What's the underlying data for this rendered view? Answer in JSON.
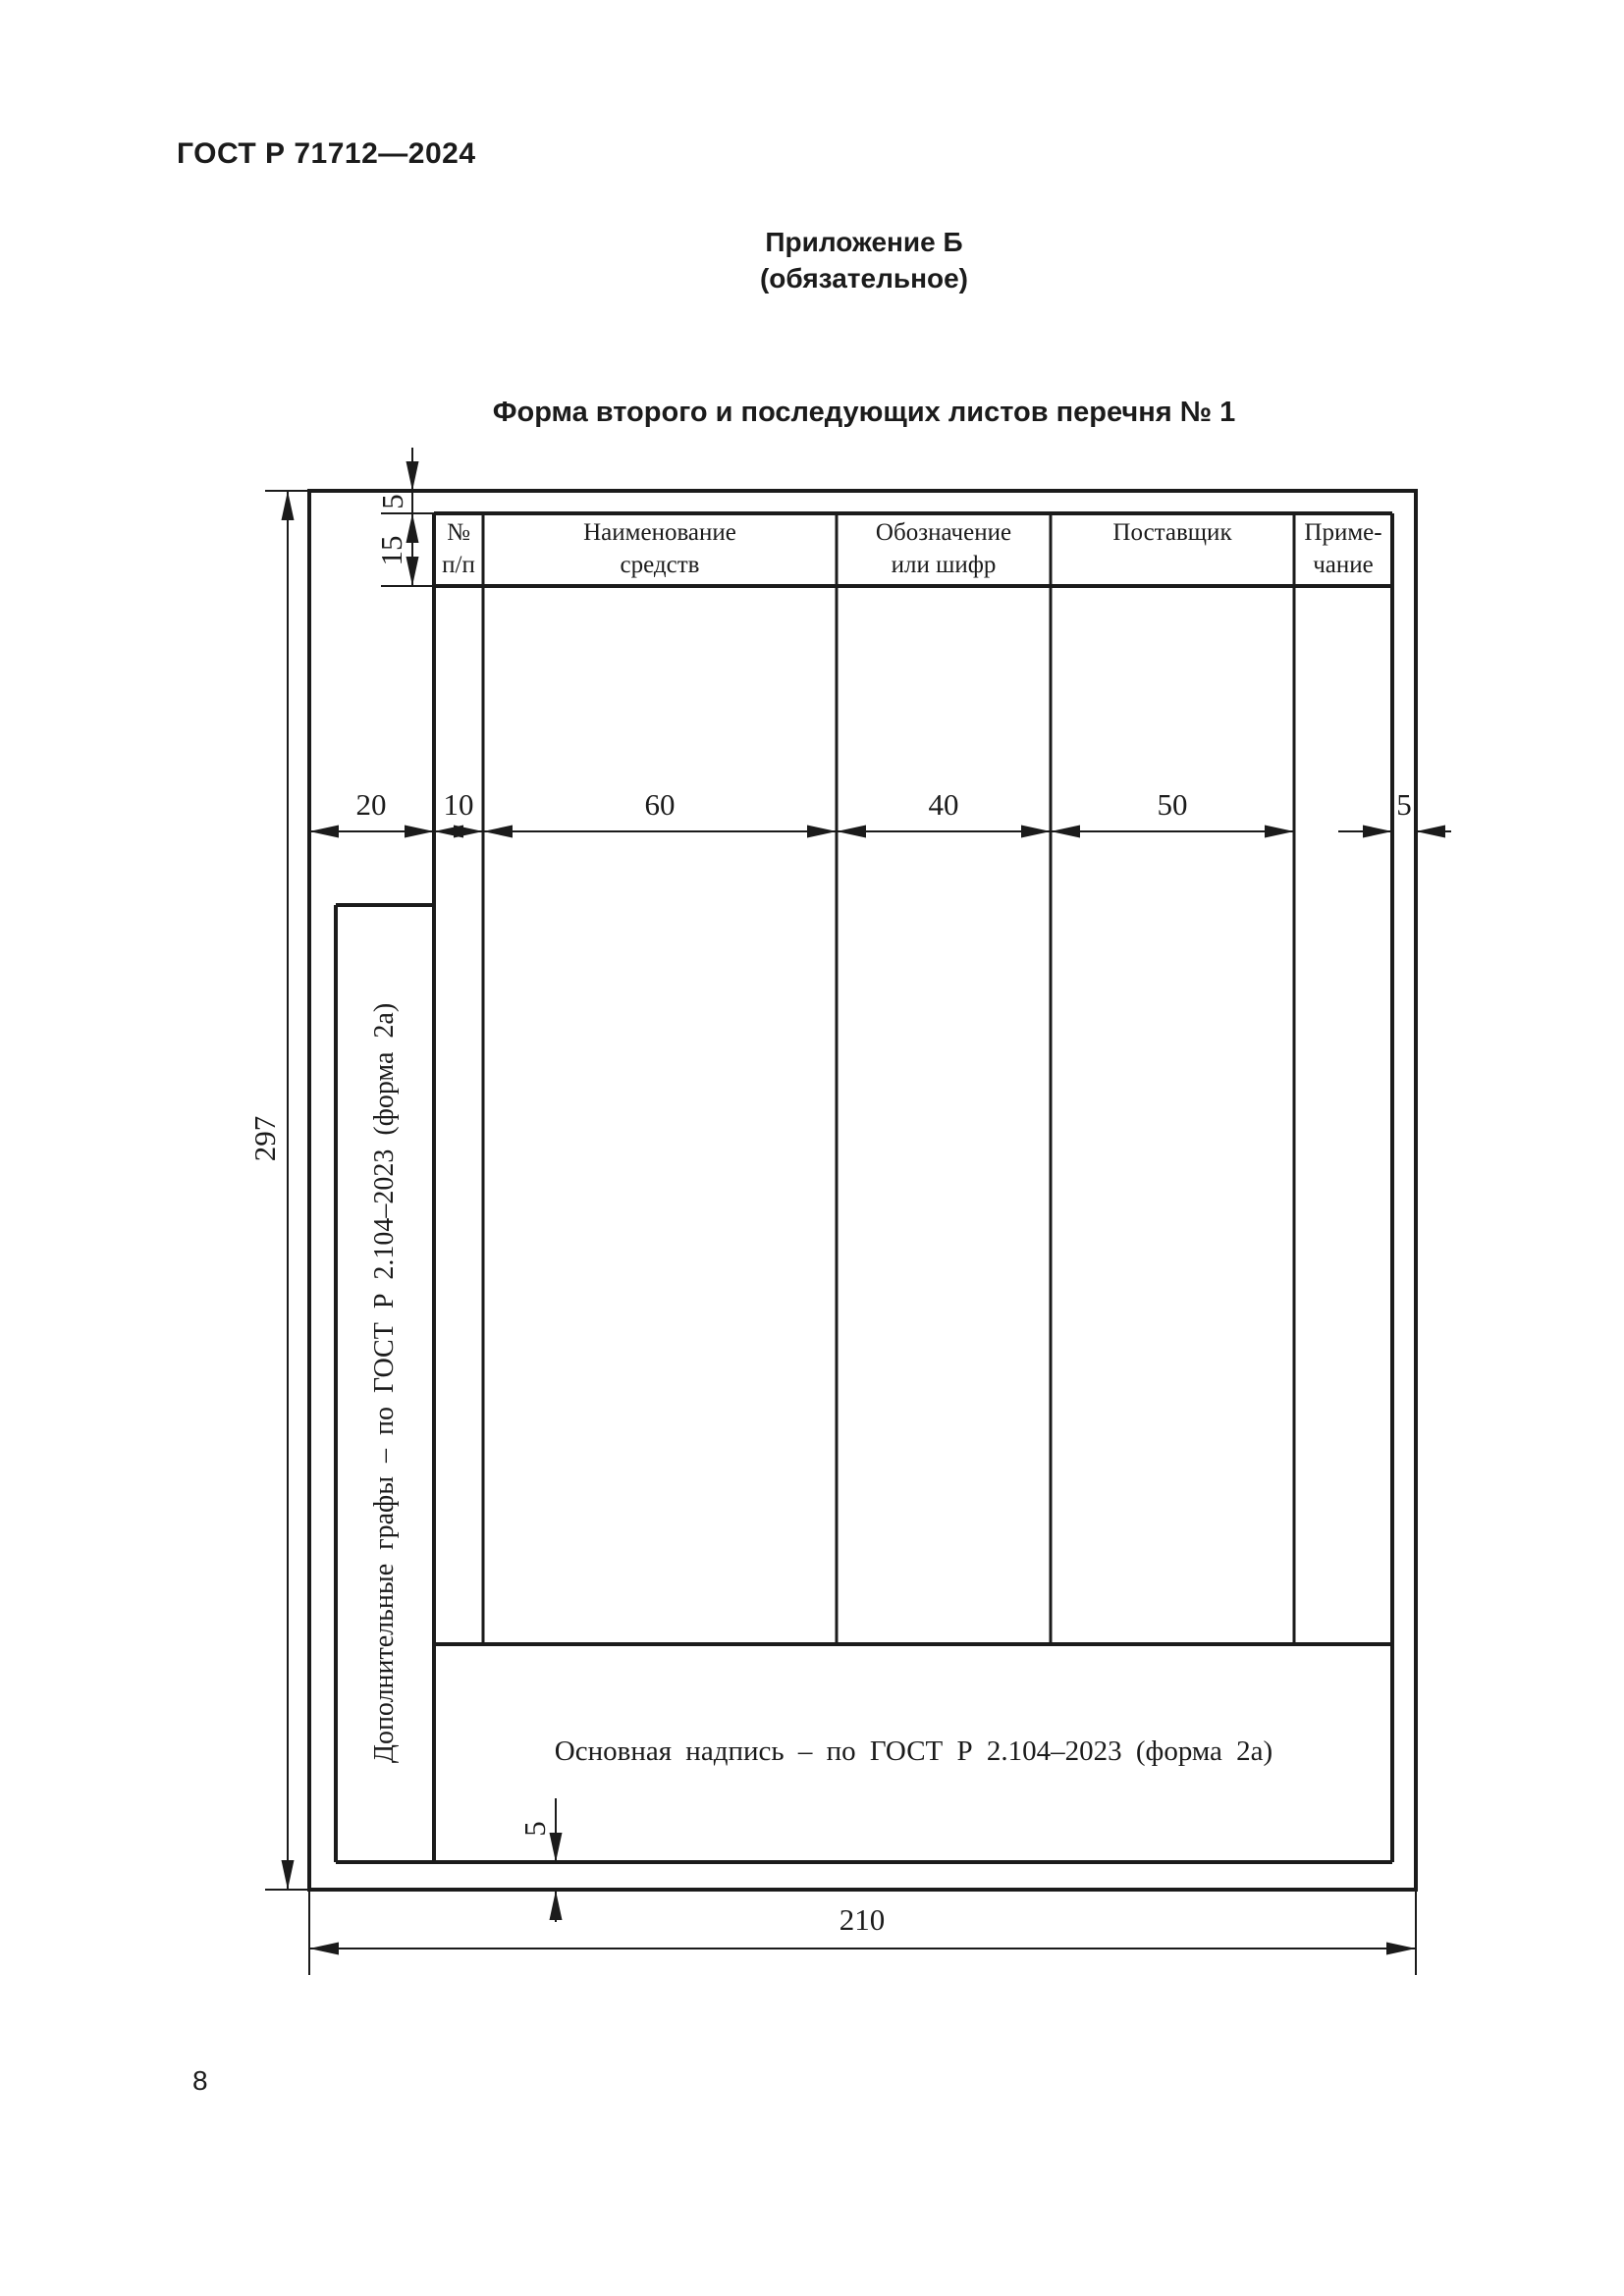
{
  "page": {
    "doc_number": "ГОСТ Р 71712—2024",
    "page_number": "8"
  },
  "appendix": {
    "title": "Приложение Б",
    "subtitle": "(обязательное)",
    "form_title": "Форма второго и последующих листов перечня № 1"
  },
  "form": {
    "table_headers": [
      {
        "line1": "№",
        "line2": "п/п"
      },
      {
        "line1": "Наименование",
        "line2": "средств"
      },
      {
        "line1": "Обозначение",
        "line2": "или шифр"
      },
      {
        "line1": "Поставщик",
        "line2": ""
      },
      {
        "line1": "Приме-",
        "line2": "чание"
      }
    ],
    "notes": {
      "additional_columns": "Дополнительные графы – по ГОСТ Р 2.104–2023 (форма 2а)",
      "main_inscription": "Основная надпись – по ГОСТ Р 2.104–2023 (форма 2а)"
    },
    "dimensions": {
      "top_margin": "5",
      "header_height": "15",
      "left_margin": "20",
      "col_number_width": "10",
      "col_name_width": "60",
      "col_designation_width": "40",
      "col_supplier_width": "50",
      "right_margin": "5",
      "bottom_margin": "5",
      "sheet_height": "297",
      "sheet_width": "210"
    },
    "ink_color": "#1b1b1b"
  }
}
